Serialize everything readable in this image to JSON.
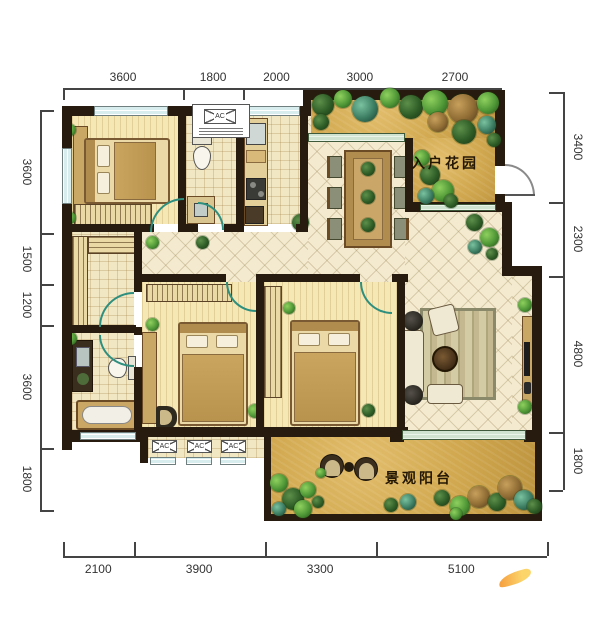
{
  "labels": {
    "entrance_garden": "入户花园",
    "balcony_garden": "景观阳台",
    "ac_unit": "AC"
  },
  "dimensions": {
    "top": [
      "3600",
      "1800",
      "2000",
      "3000",
      "2700"
    ],
    "bottom": [
      "2100",
      "3900",
      "3300",
      "5100"
    ],
    "left": [
      "3600",
      "1500",
      "1200",
      "3600",
      "1800"
    ],
    "right": [
      "3400",
      "2300",
      "4800",
      "1800"
    ]
  },
  "colors": {
    "wall": "#261b0e",
    "wood_floor": "#f5e8b4",
    "tile_floor": "#f2e7c3",
    "garden_floor": "#d4a94f",
    "window_glass": "#d8edee",
    "door_arc": "#2e8f7f",
    "dimension_text": "#333333",
    "label_text": "#241703",
    "logo_orange": "#f59b3c"
  }
}
